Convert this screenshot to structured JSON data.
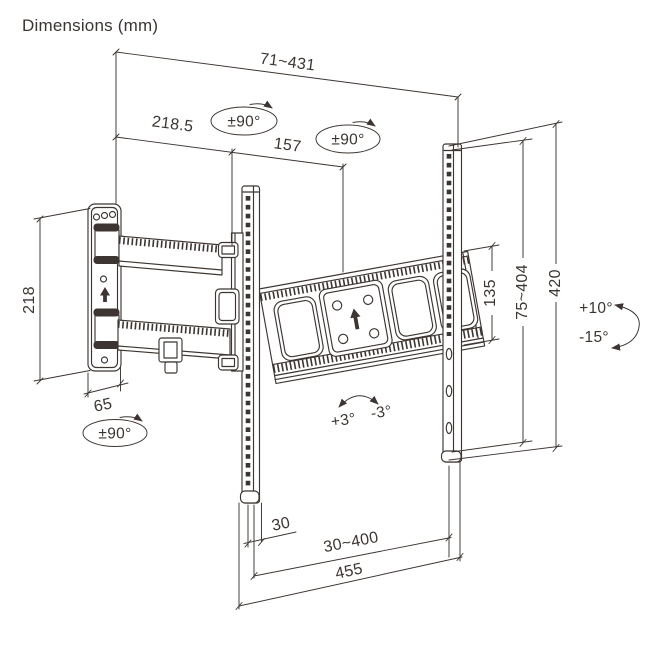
{
  "title": "Dimensions (mm)",
  "colors": {
    "line": "#3c3531",
    "background": "#ffffff"
  },
  "dimensions": {
    "depth_range": "71~431",
    "arm_segment_rear": "218.5",
    "arm_segment_front": "157",
    "wall_plate_height": "218",
    "wall_plate_width": "65",
    "bracket_end_height": "135",
    "tv_mount_height_range": "75~404",
    "rail_length": "420",
    "side_offset": "30",
    "tv_hole_width_range": "30~400",
    "crossbar_length": "455"
  },
  "angles": {
    "swivel_arm_rear": "±90°",
    "swivel_arm_front": "±90°",
    "swivel_wall_joint": "±90°",
    "tilt_up": "+10°",
    "tilt_down": "-15°",
    "post_level_cw": "+3°",
    "post_level_ccw": "-3°"
  }
}
